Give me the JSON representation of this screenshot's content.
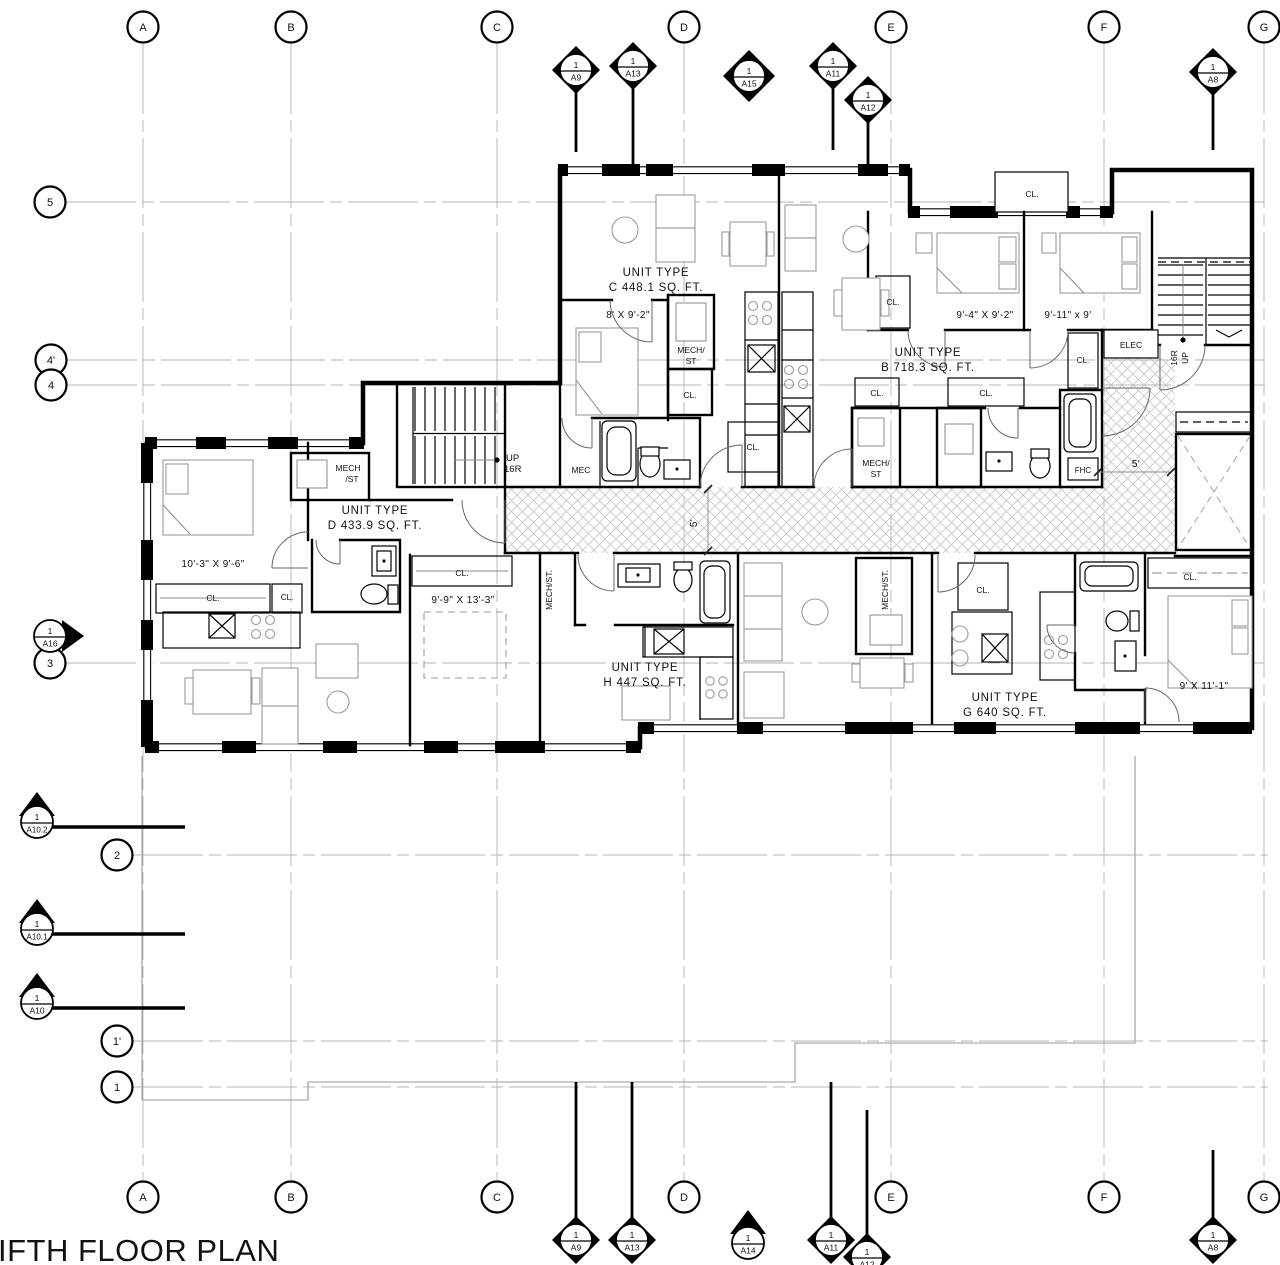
{
  "title": "IFTH FLOOR PLAN",
  "grid": {
    "columns": [
      {
        "label": "A"
      },
      {
        "label": "B"
      },
      {
        "label": "C"
      },
      {
        "label": "D"
      },
      {
        "label": "E"
      },
      {
        "label": "F"
      },
      {
        "label": "G"
      }
    ],
    "rows": [
      {
        "label": "5"
      },
      {
        "label": "4'"
      },
      {
        "label": "4"
      },
      {
        "label": "3"
      },
      {
        "label": "2"
      },
      {
        "label": "1'"
      },
      {
        "label": "1"
      }
    ]
  },
  "markers": {
    "top": [
      {
        "num": "1",
        "sheet": "A9"
      },
      {
        "num": "1",
        "sheet": "A13"
      },
      {
        "num": "1",
        "sheet": "A15"
      },
      {
        "num": "1",
        "sheet": "A11"
      },
      {
        "num": "1",
        "sheet": "A12"
      },
      {
        "num": "1",
        "sheet": "A8"
      }
    ],
    "left": [
      {
        "num": "1",
        "sheet": "A16"
      },
      {
        "num": "1",
        "sheet": "A10.2"
      },
      {
        "num": "1",
        "sheet": "A10.1"
      },
      {
        "num": "1",
        "sheet": "A10"
      }
    ],
    "bottom": [
      {
        "num": "1",
        "sheet": "A9"
      },
      {
        "num": "1",
        "sheet": "A13"
      },
      {
        "num": "1",
        "sheet": "A14"
      },
      {
        "num": "1",
        "sheet": "A11"
      },
      {
        "num": "1",
        "sheet": "A12"
      },
      {
        "num": "1",
        "sheet": "A8"
      }
    ]
  },
  "units": [
    {
      "line1": "UNIT TYPE",
      "line2": "C 448.1 SQ. FT."
    },
    {
      "line1": "UNIT TYPE",
      "line2": "B 718.3 SQ. FT."
    },
    {
      "line1": "UNIT TYPE",
      "line2": "D 433.9 SQ. FT."
    },
    {
      "line1": "UNIT TYPE",
      "line2": "H 447 SQ. FT."
    },
    {
      "line1": "UNIT TYPE",
      "line2": "G 640 SQ. FT."
    }
  ],
  "dims": {
    "c_bed": "8' X 9'-2\"",
    "b_bed1": "9'-4\" X 9'-2\"",
    "b_bed2": "9'-11\" x 9'",
    "d_bed": "10'-3\" X 9'-6\"",
    "h_bed": "9'-9\" X 13'-3\"",
    "g_bed": "9' X 11'-1\"",
    "corridor": "5'",
    "elevator": "5'"
  },
  "rooms": {
    "cl": "CL.",
    "mech1": "MECH/",
    "mech2": "ST",
    "mechd1": "MECH",
    "mechd2": "/ST",
    "mech_v": "MECH/ST.",
    "mec": "MEC",
    "elec": "ELEC",
    "fhc": "FHC",
    "up": "UP",
    "r16": "16R"
  }
}
